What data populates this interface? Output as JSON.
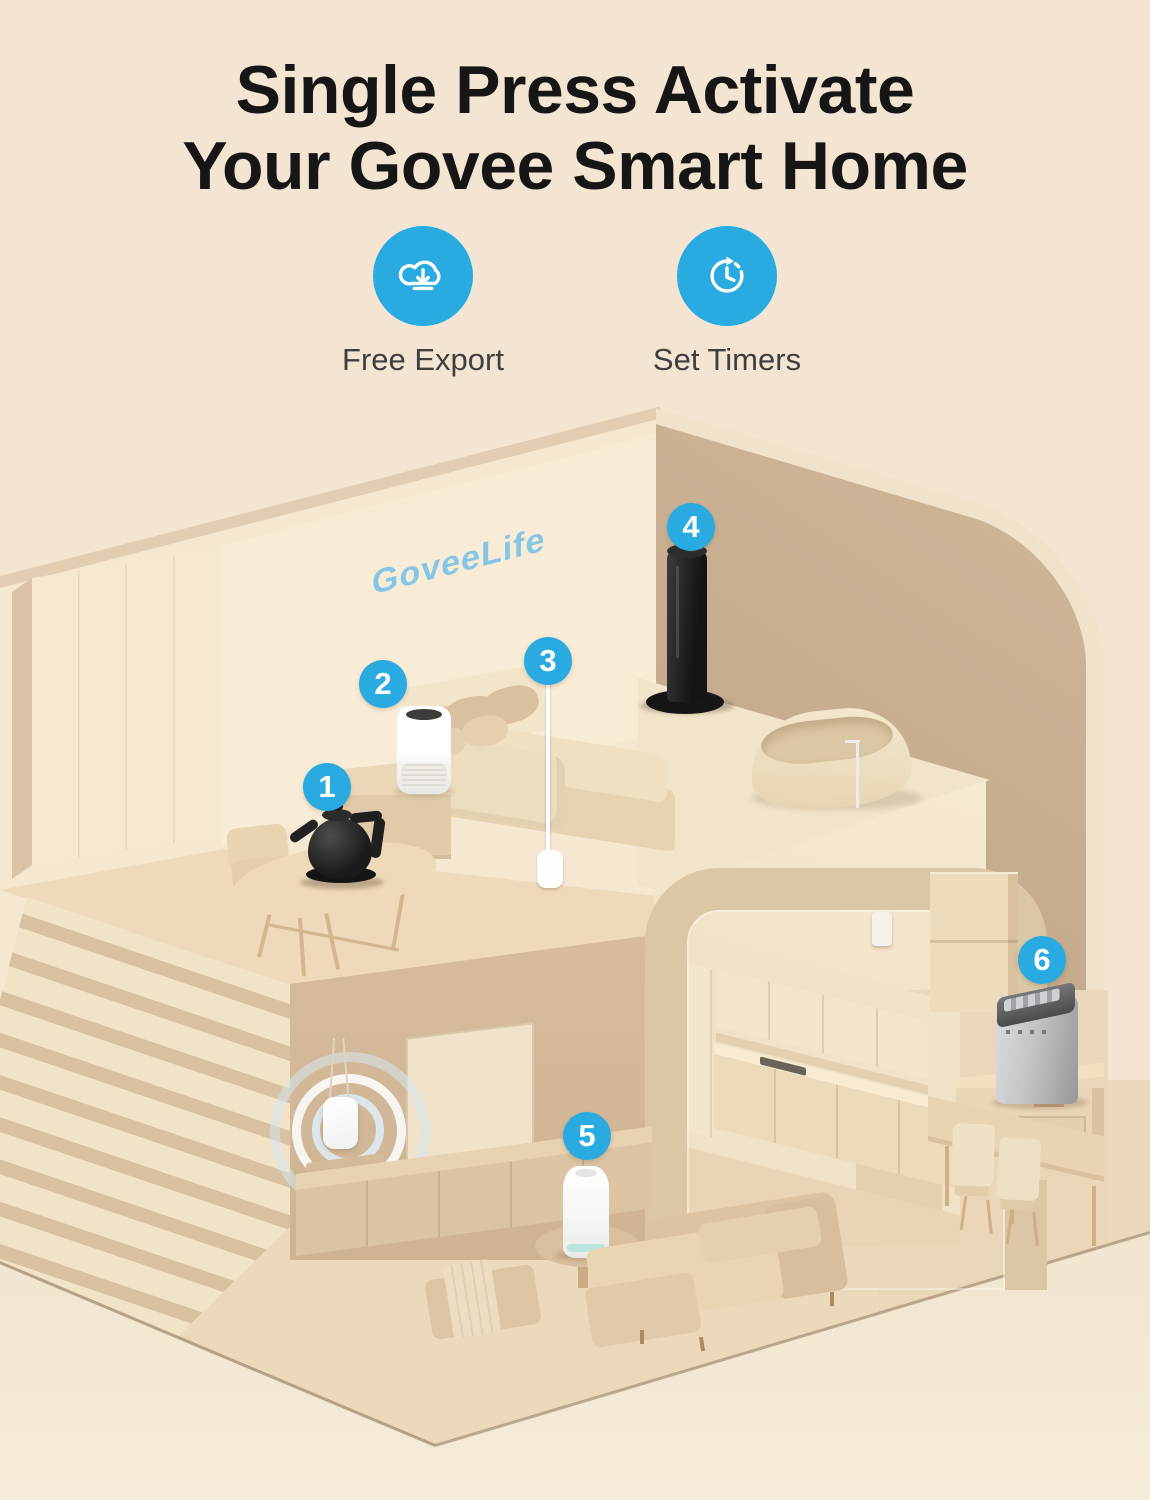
{
  "header": {
    "title_line1": "Single Press Activate",
    "title_line2": "Your Govee Smart Home",
    "features": [
      {
        "label": "Free Export",
        "icon": "cloud-download-icon"
      },
      {
        "label": "Set Timers",
        "icon": "timer-icon"
      }
    ]
  },
  "scene": {
    "wall_logo": "GoveeLife",
    "markers": [
      {
        "number": "1",
        "device": "smart-kettle"
      },
      {
        "number": "2",
        "device": "air-purifier"
      },
      {
        "number": "3",
        "device": "floor-lamp"
      },
      {
        "number": "4",
        "device": "tower-fan"
      },
      {
        "number": "5",
        "device": "humidifier"
      },
      {
        "number": "6",
        "device": "ice-maker"
      }
    ]
  },
  "colors": {
    "accent_blue": "#29abe2",
    "logo_blue": "#85c6e6",
    "background": "#f4e5d2",
    "wall_dark": "#c9ae8f",
    "platform_tan": "#d3b897",
    "title_color": "#161616",
    "label_color": "#3f3f3f"
  }
}
